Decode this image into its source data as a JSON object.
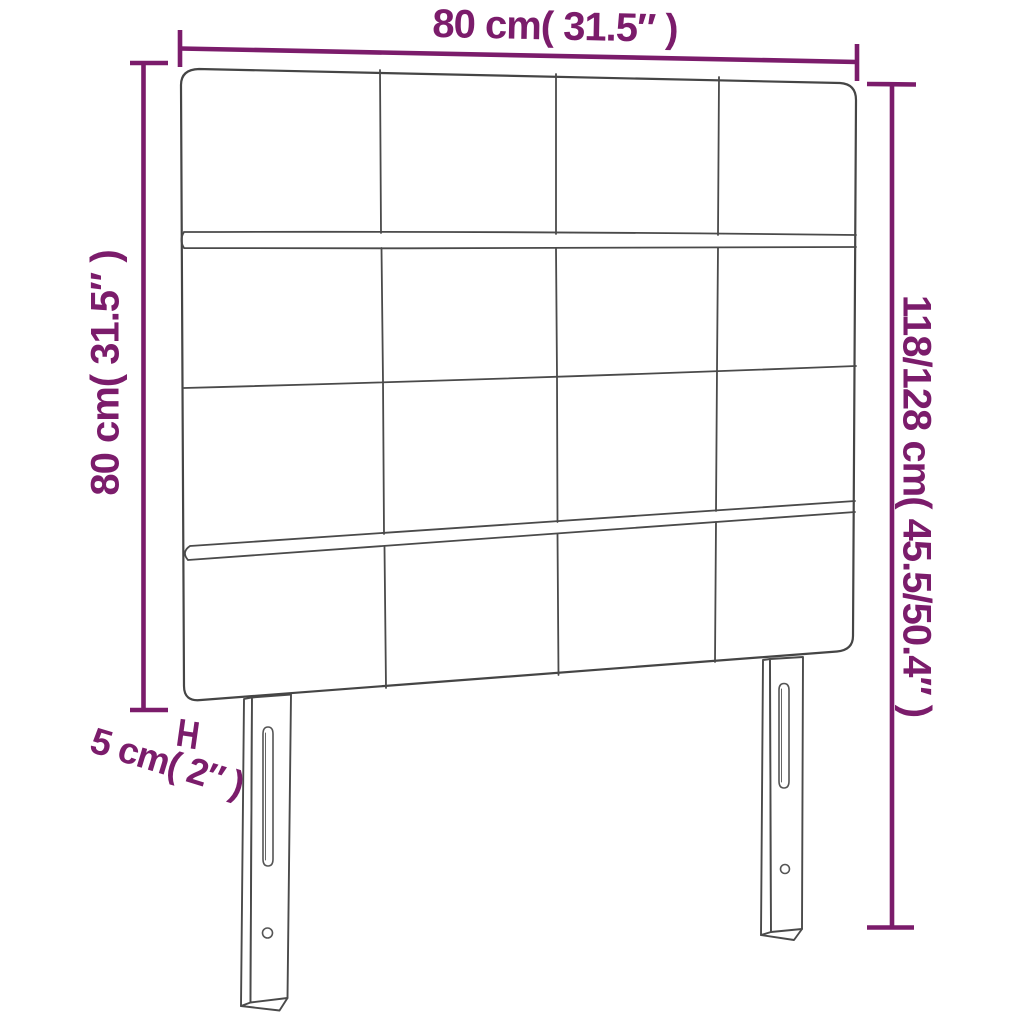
{
  "figure": {
    "type": "product-dimension-diagram",
    "subject": "headboard"
  },
  "colors": {
    "accent": "#7b1c6b",
    "outline": "#454545",
    "background": "#ffffff"
  },
  "icons": {
    "thickness_bracket": "h-shaped-dimension-bracket"
  },
  "dimensions": {
    "width": {
      "label": "80 cm( 31.5″ )"
    },
    "panel_height": {
      "label": "80 cm( 31.5″ )"
    },
    "total_height": {
      "label": "118/128 cm( 45.5/50.4″ )"
    },
    "thickness": {
      "label": "5 cm( 2″ )"
    }
  }
}
